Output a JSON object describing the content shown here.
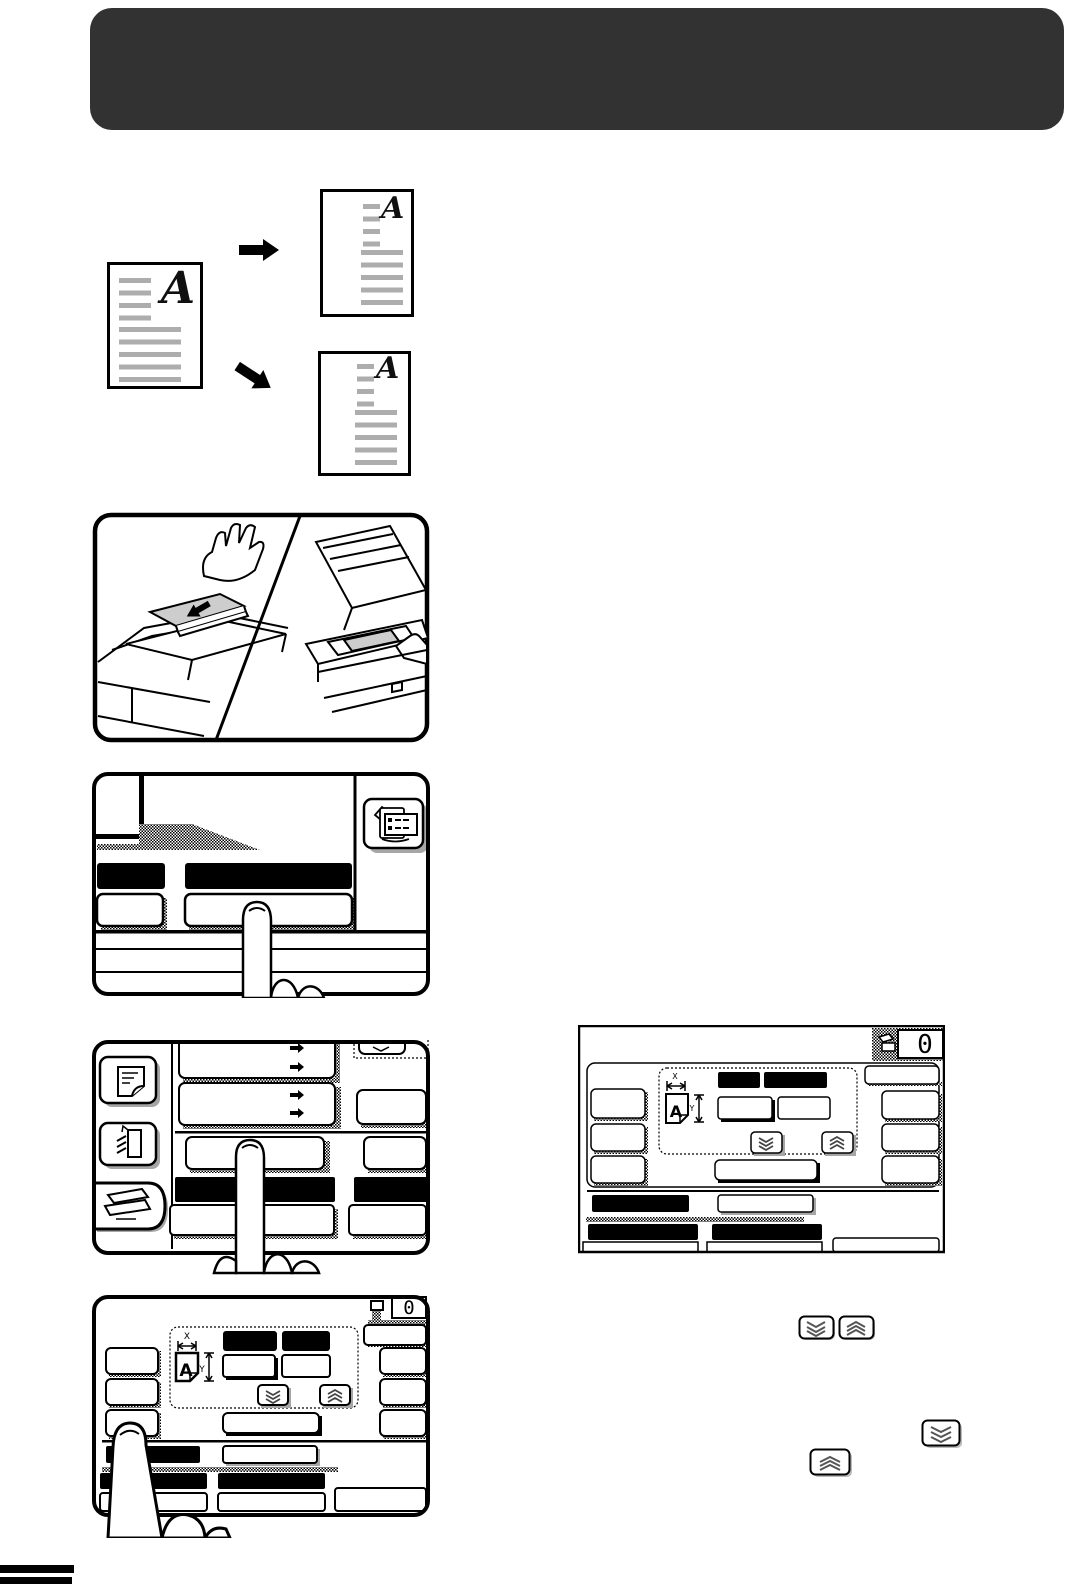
{
  "orientation_diagram": {
    "original_letter": "A",
    "copy1_letter": "A",
    "copy2_letter": "A"
  },
  "size_screen": {
    "counter": "0",
    "x_axis_label": "X",
    "y_axis_label": "Y",
    "paper_icon_letter": "A"
  },
  "crop_screen": {
    "counter": "0",
    "x_axis_label": "X",
    "y_axis_label": "Y",
    "paper_icon_letter": "A"
  },
  "icons": {
    "special_modes_key": "copier-with-settings-list-icon",
    "scroll_down_key": "triple-chevron-down",
    "scroll_up_key": "triple-chevron-up",
    "output_counter": "paper-output-icon",
    "sidebar_top": "page-with-curl-icon",
    "sidebar_middle": "document-feeder-icon",
    "sidebar_bottom": "platen-glass-icon"
  },
  "colors": {
    "banner": "#323232",
    "document_line_gray": "#adadad",
    "paper_gray": "#cdcdcd",
    "shadow_gray": "#a6a6a6"
  }
}
